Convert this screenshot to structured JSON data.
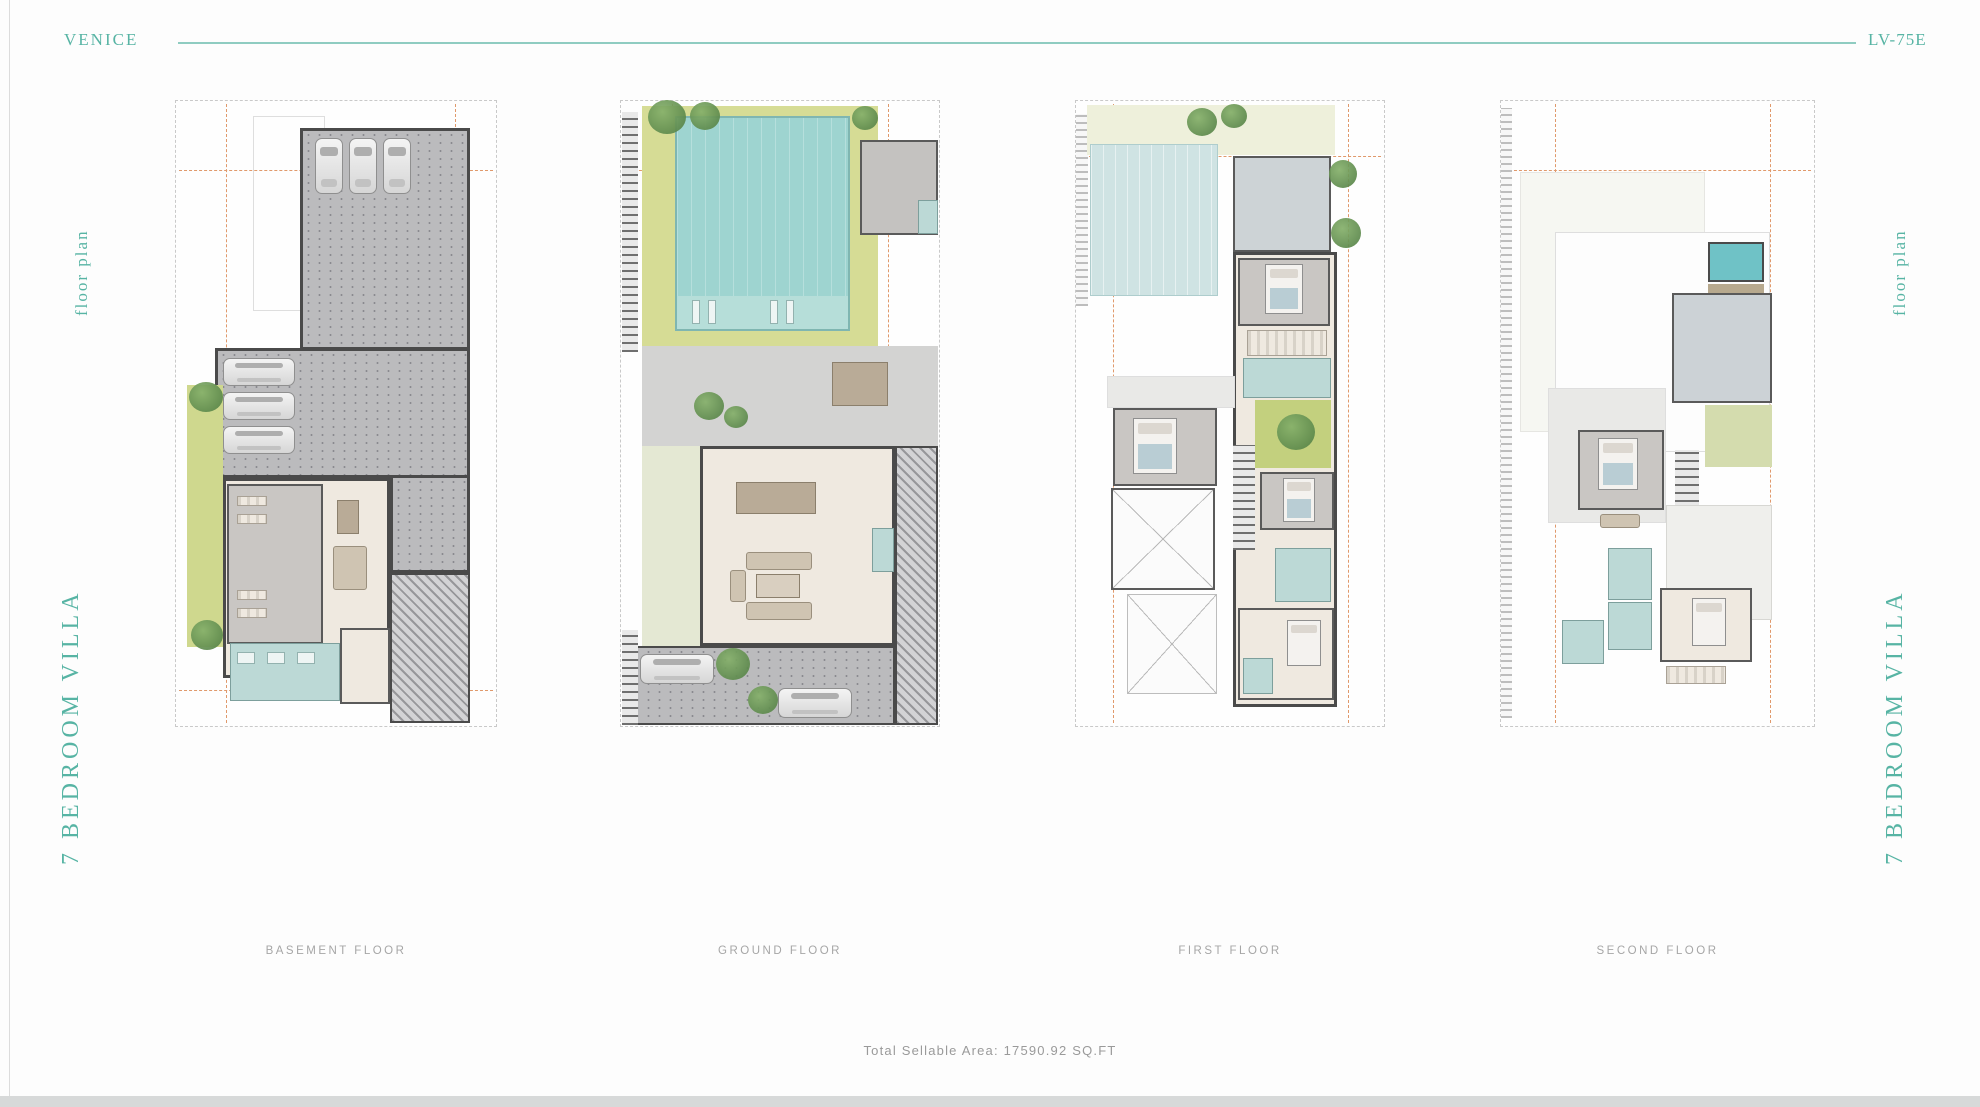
{
  "header": {
    "project_name": "VENICE",
    "unit_code": "LV-75E"
  },
  "sidebar_left": {
    "plan_type_label": "floor plan",
    "villa_label": "7 BEDROOM VILLA"
  },
  "sidebar_right": {
    "plan_type_label": "floor plan",
    "villa_label": "7 BEDROOM VILLA"
  },
  "plans": [
    {
      "id": "basement-floor",
      "label": "BASEMENT FLOOR"
    },
    {
      "id": "ground-floor",
      "label": "GROUND FLOOR"
    },
    {
      "id": "first-floor",
      "label": "FIRST FLOOR"
    },
    {
      "id": "second-floor",
      "label": "SECOND FLOOR"
    }
  ],
  "footer": {
    "total_sellable_area": "Total Sellable Area: 17590.92 SQ.FT"
  },
  "colors": {
    "brand_teal": "#57b4a4",
    "divider_teal": "#8fccc1",
    "label_gray": "#a6a6a6",
    "grid_orange": "#e0996b",
    "pool_teal": "#9ed4d0",
    "lawn_green": "#cfd88e",
    "bath_blue": "#bcd9d6",
    "driveway_gray": "#bbbbbd"
  }
}
